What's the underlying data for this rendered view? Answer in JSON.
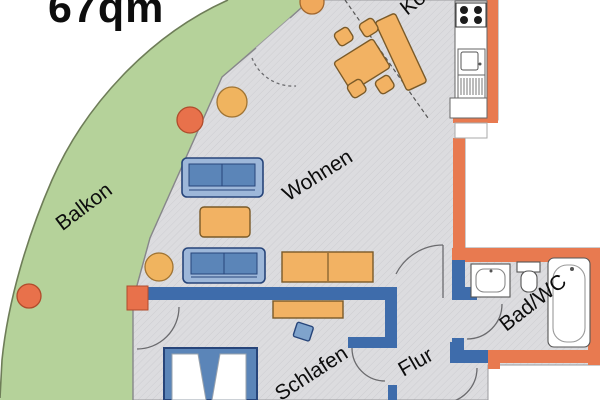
{
  "plan": {
    "area_label": "67qm",
    "rooms": {
      "balcony": "Balkon",
      "living": "Wohnen",
      "kitchen": "Kochen",
      "bedroom": "Schlafen",
      "hallway": "Flur",
      "bathroom": "Bad/WC"
    },
    "colors": {
      "exterior_wall": "#e87a50",
      "interior_wall": "#3e6cab",
      "balcony_green": "#b5d29a",
      "floor_grey": "#dcdcdf",
      "furniture_wood": "#f2b263",
      "furniture_blue": "#5b85b8",
      "sofa_light_blue": "#9db7d9",
      "plant_red": "#e8714b",
      "plant_yellow": "#f0b45f",
      "label_black": "#0d0d0d"
    }
  }
}
